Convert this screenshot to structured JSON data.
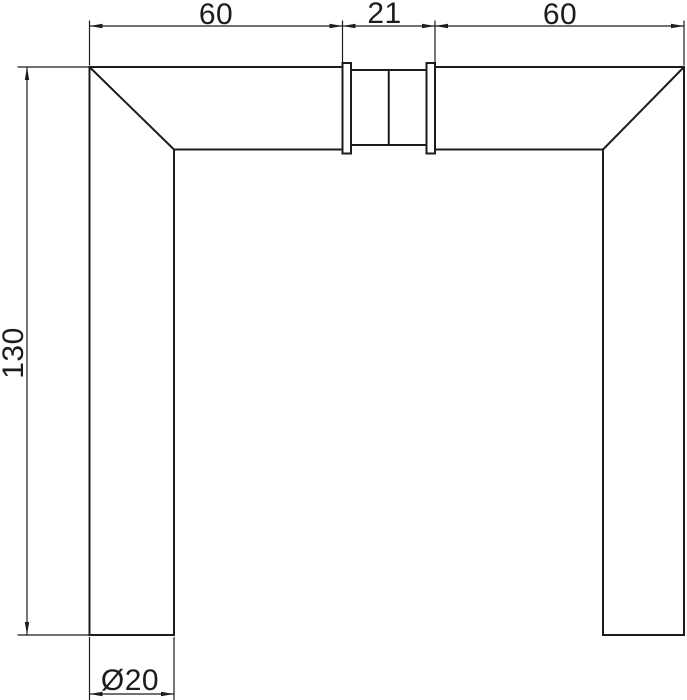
{
  "colors": {
    "line": "#1c1c1c",
    "background": "#ffffff"
  },
  "dimensions": {
    "top_left_width": "60",
    "spindle_width": "21",
    "top_right_width": "60",
    "side_height": "130",
    "bar_diameter": "Ø20"
  }
}
